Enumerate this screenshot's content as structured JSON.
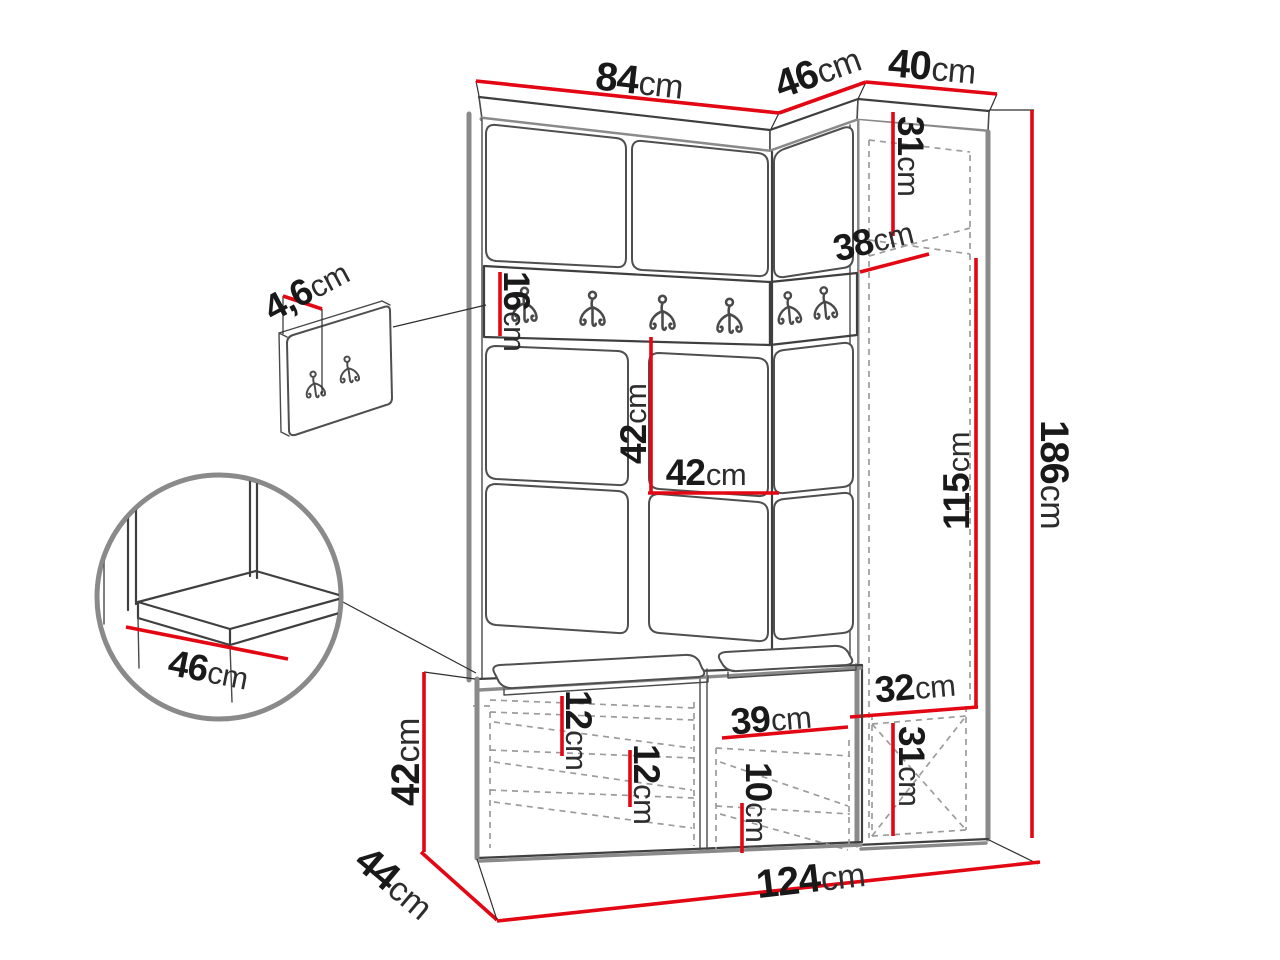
{
  "colors": {
    "dimension_line": "#e30613",
    "outline": "#3f3f3f",
    "soft_edge": "#8a8a8a",
    "hidden_line": "#9c9c9c",
    "label_text": "#191919",
    "background": "#ffffff"
  },
  "labels": {
    "top_width": {
      "value": "84",
      "unit": "cm"
    },
    "corner_depth": {
      "value": "46",
      "unit": "cm"
    },
    "right_width": {
      "value": "40",
      "unit": "cm"
    },
    "upper_compartment_height": {
      "value": "31",
      "unit": "cm"
    },
    "shelf_depth": {
      "value": "38",
      "unit": "cm"
    },
    "wall_panel_thickness": {
      "value": "4,6",
      "unit": "cm"
    },
    "hook_rail_height": {
      "value": "16",
      "unit": "cm"
    },
    "panel_height": {
      "value": "42",
      "unit": "cm"
    },
    "panel_width": {
      "value": "42",
      "unit": "cm"
    },
    "side_cabinet_inner_height": {
      "value": "115",
      "unit": "cm"
    },
    "total_height": {
      "value": "186",
      "unit": "cm"
    },
    "seat_depth": {
      "value": "46",
      "unit": "cm"
    },
    "bench_height": {
      "value": "42",
      "unit": "cm"
    },
    "bench_depth": {
      "value": "44",
      "unit": "cm"
    },
    "bench_shelf_gap_top": {
      "value": "12",
      "unit": "cm"
    },
    "bench_shelf_gap_middle": {
      "value": "12",
      "unit": "cm"
    },
    "bench_compartment_width": {
      "value": "39",
      "unit": "cm"
    },
    "bench_shelf_gap_bottom": {
      "value": "10",
      "unit": "cm"
    },
    "total_width": {
      "value": "124",
      "unit": "cm"
    },
    "lower_compartment_width": {
      "value": "32",
      "unit": "cm"
    },
    "lower_compartment_height": {
      "value": "31",
      "unit": "cm"
    }
  }
}
